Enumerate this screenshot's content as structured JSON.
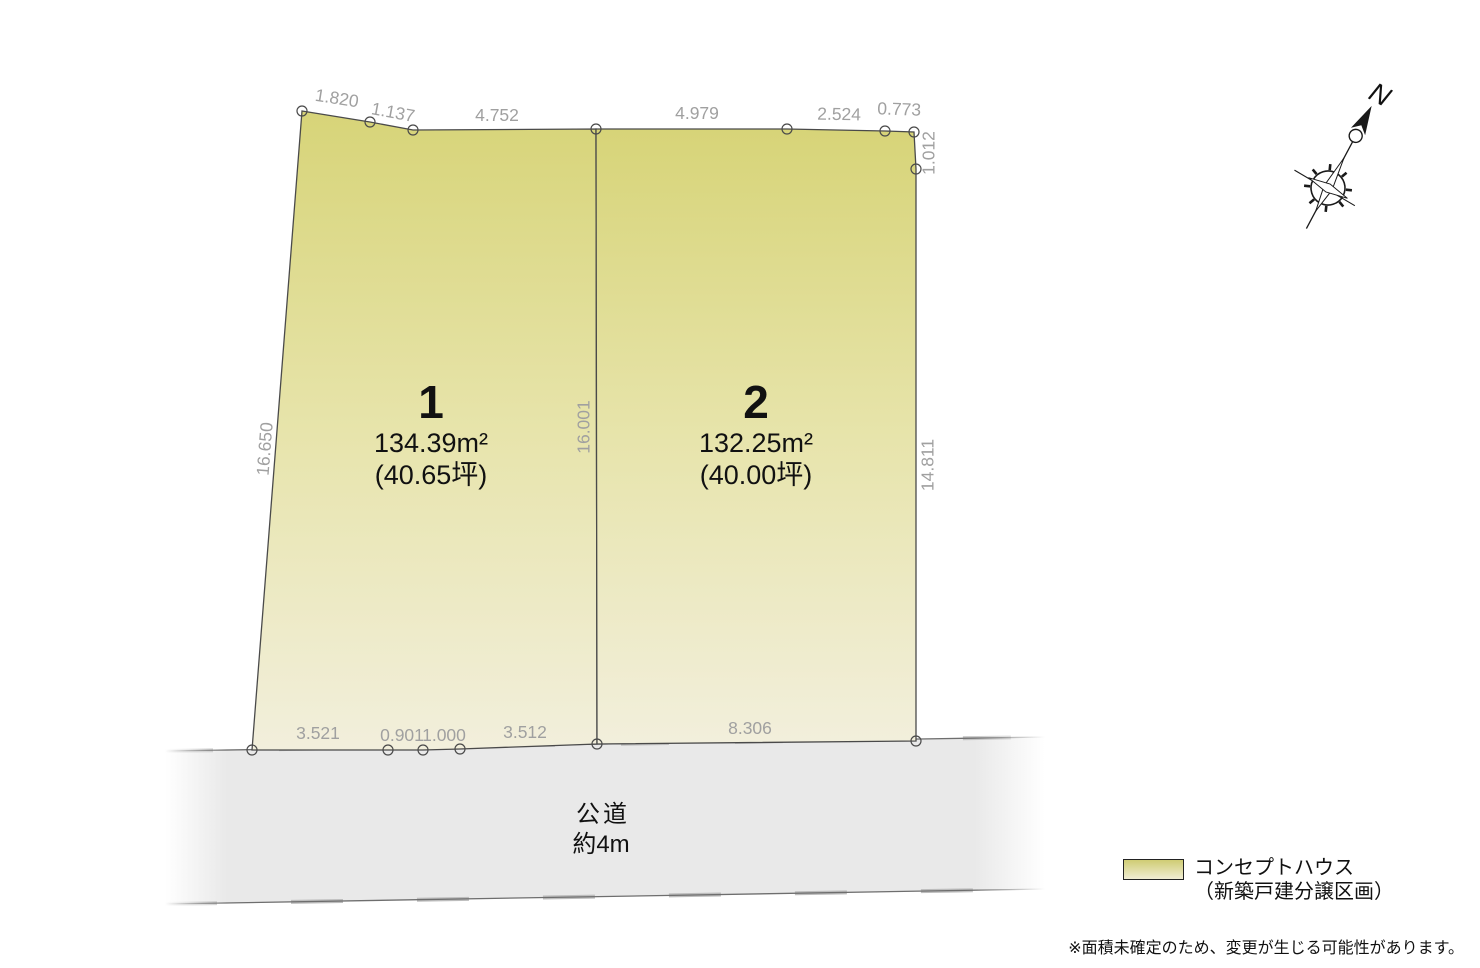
{
  "plots": [
    {
      "number": "1",
      "area": "134.39m²",
      "tsubo": "(40.65坪)"
    },
    {
      "number": "2",
      "area": "132.25m²",
      "tsubo": "(40.00坪)"
    }
  ],
  "dims": {
    "top": [
      "1.820",
      "1.137",
      "4.752",
      "4.979",
      "2.524",
      "0.773"
    ],
    "right": [
      "1.012",
      "14.811"
    ],
    "left": [
      "16.650"
    ],
    "center": [
      "16.001"
    ],
    "bottom": [
      "3.521",
      "0.901",
      "1.000",
      "3.512",
      "8.306"
    ]
  },
  "road": {
    "name": "公道",
    "width": "約4m"
  },
  "compass": {
    "label": "N"
  },
  "legend": {
    "line1": "コンセプトハウス",
    "line2": "（新築戸建分譲区画）"
  },
  "footnote": {
    "text": "※面積未確定のため、変更が生じる可能性があります。"
  },
  "colors": {
    "plot_fill_top": "#d7d478",
    "plot_fill_bottom": "#f2efdc",
    "road_fill": "#e9e9e9",
    "outline": "#4a4a4a",
    "dim_text": "#a0a0a0"
  }
}
